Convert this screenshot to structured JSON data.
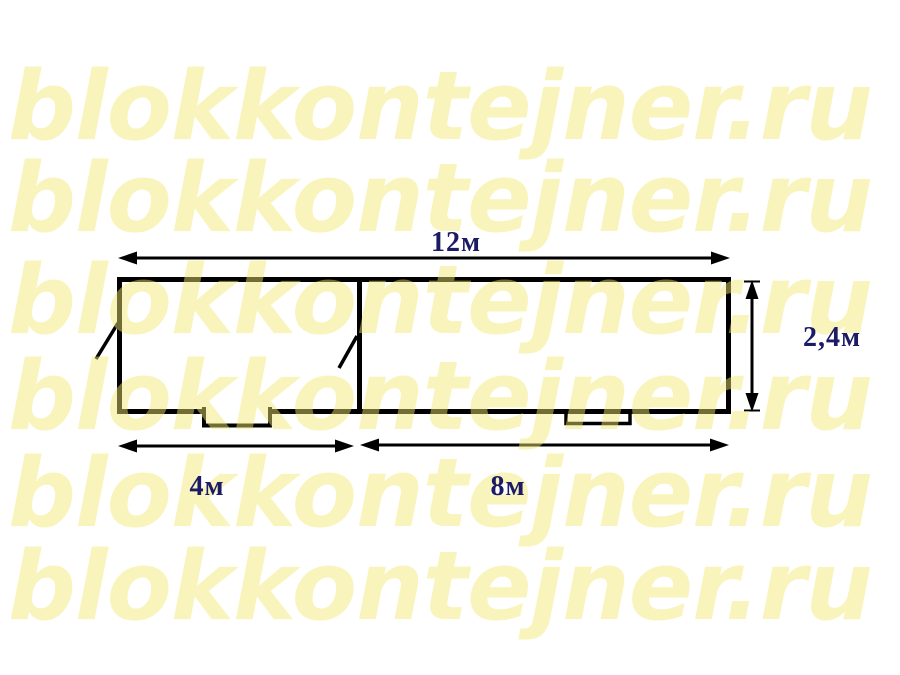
{
  "watermark": {
    "text": "blokkontejner.ru",
    "rows": 6
  },
  "diagram": {
    "type": "floor-plan",
    "labels": {
      "total_length": "12м",
      "container_width": "2,4м",
      "left_section": "4м",
      "right_section": "8м"
    }
  },
  "colors": {
    "watermark": "rgba(240,232,110,0.47)",
    "dimension_label": "#1B1B66",
    "line": "#000000",
    "background": "#FFFFFF"
  }
}
